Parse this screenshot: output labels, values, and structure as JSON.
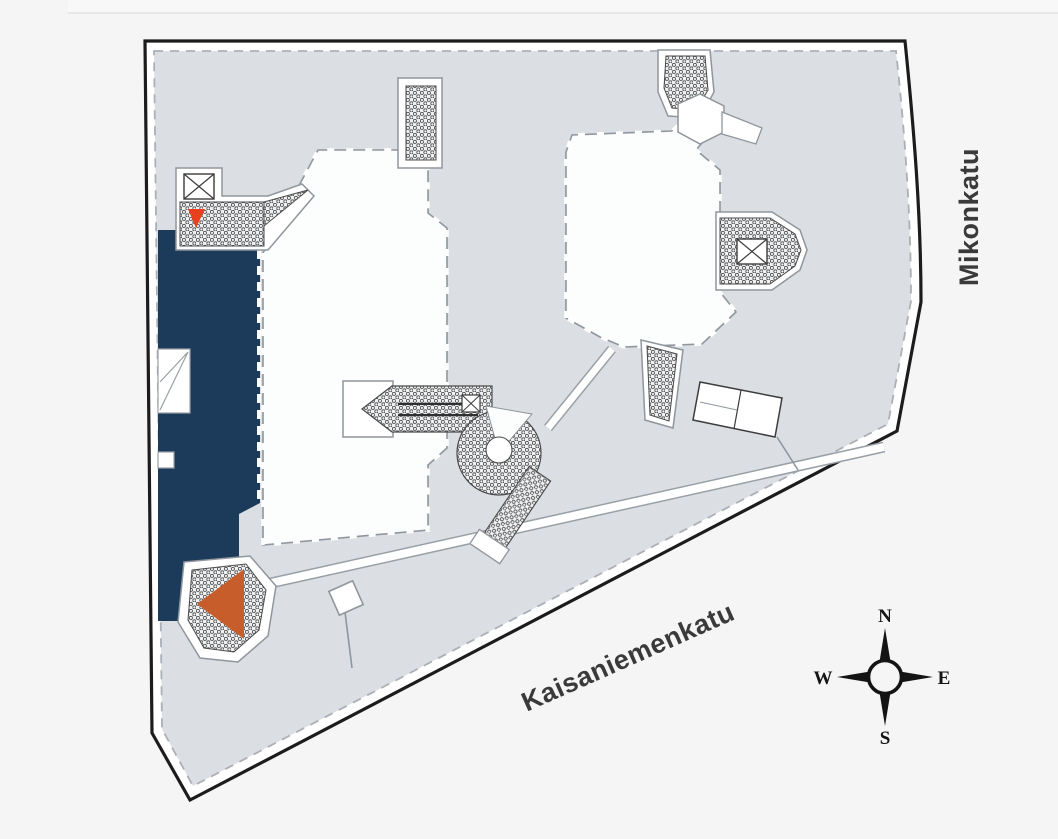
{
  "page": {
    "background": "#f5f5f6"
  },
  "map": {
    "type": "building-floor-plan",
    "streets": {
      "east": {
        "name": "Mikonkatu",
        "orientation": "vertical"
      },
      "south": {
        "name": "Kaisaniemenkatu",
        "orientation": "diagonal"
      }
    },
    "compass": {
      "north": "N",
      "east": "E",
      "south": "S",
      "west": "W"
    },
    "highlighted_unit": {
      "description": "selected retail unit",
      "color": "#1c3a5a"
    },
    "markers": {
      "small_entrance_marker": {
        "shape": "triangle-down",
        "color": "#e8401c"
      },
      "large_unit_marker": {
        "shape": "triangle-left",
        "color": "#c75d2a"
      }
    },
    "colors": {
      "building_fill": "#dbdfe3",
      "wall_band": "#ffffff",
      "outline": "#1c1c1c",
      "courtyard": "#fcfdfd",
      "wall_line": "#8f969c",
      "hatch_bg": "#eef0f1",
      "hatch_fg": "#4a4a4a",
      "divider": "#e7e7ea"
    }
  }
}
